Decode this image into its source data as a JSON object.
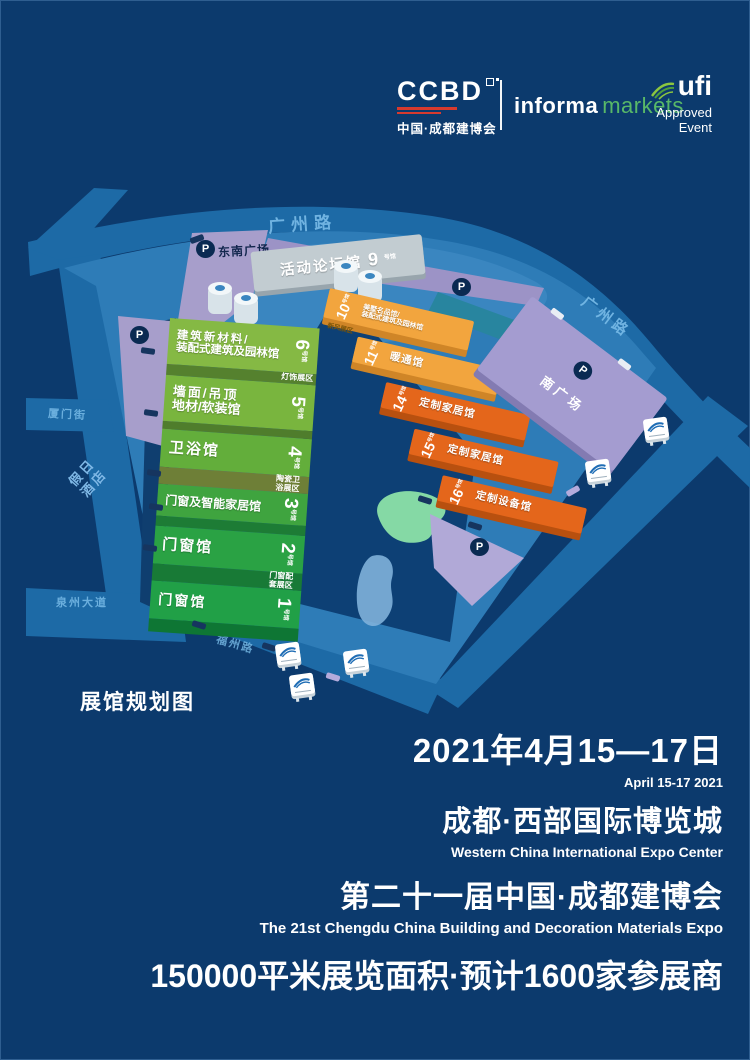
{
  "header": {
    "ccbd": {
      "wordmark": "CCBD",
      "cn": "中国·成都建博会"
    },
    "informa": {
      "word1": "informa",
      "word2": "markets"
    },
    "ufi": {
      "name": "ufi",
      "approved": "Approved",
      "event": "Event"
    }
  },
  "map": {
    "title": "展馆规划图",
    "parking_label": "P",
    "hall_suffix": "号馆",
    "roads": {
      "top": "广州路",
      "right": "广州路",
      "left": "厦门街",
      "bottom_left": "泉州大道",
      "bottom": "福州路"
    },
    "places": {
      "southeast_plaza": "东南广场",
      "south_plaza": "南广场",
      "hotel": "假日酒店",
      "forum_hall": "活动论坛馆",
      "forum_no": "9"
    },
    "green_halls": [
      {
        "no": "6",
        "name_l1": "建筑新材料/",
        "name_l2": "装配式建筑及园林馆",
        "sub": "灯饰展区"
      },
      {
        "no": "5",
        "name_l1": "墙面/吊顶",
        "name_l2": "地材/软装馆",
        "sub": ""
      },
      {
        "no": "4",
        "name": "卫浴馆",
        "sub": "陶瓷卫浴展区"
      },
      {
        "no": "3",
        "name": "门窗及智能家居馆",
        "sub": ""
      },
      {
        "no": "2",
        "name": "门窗馆",
        "sub": "门窗配套展区"
      },
      {
        "no": "1",
        "name": "门窗馆",
        "sub": ""
      }
    ],
    "orange_halls": [
      {
        "no": "10",
        "name_l1": "美墅名品馆/",
        "name_l2": "装配式建筑及园林馆",
        "sub": "新风展区"
      },
      {
        "no": "11",
        "name": "暖通馆"
      },
      {
        "no": "14",
        "name": "定制家居馆"
      },
      {
        "no": "15",
        "name": "定制家居馆"
      },
      {
        "no": "16",
        "name": "定制设备馆"
      }
    ]
  },
  "footer": {
    "date_cn": "2021年4月15—17日",
    "date_en": "April 15-17 2021",
    "venue_cn": "成都·西部国际博览城",
    "venue_en": "Western China International Expo Center",
    "event_cn": "第二十一届中国·成都建博会",
    "event_en": "The 21st Chengdu China Building and Decoration Materials Expo",
    "stats": "150000平米展览面积·预计1600家参展商"
  },
  "colors": {
    "background": "#0c3a6d",
    "road": "#1d6aa6",
    "deck": "#2e7cb7",
    "courtyard": "#0d4075",
    "green_hall": "#6db33e",
    "orange_light": "#f2a53e",
    "orange_dark": "#e4661b",
    "purple": "#a49cd0",
    "markets_green": "#58b868",
    "text": "#ffffff"
  }
}
